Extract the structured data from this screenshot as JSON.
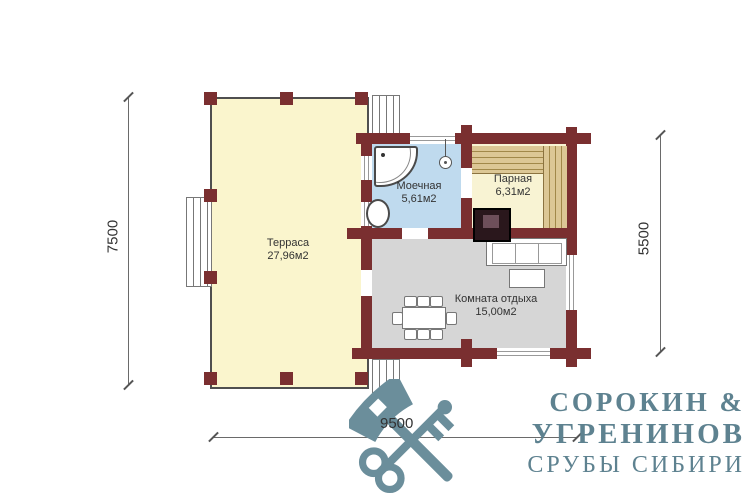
{
  "plan": {
    "dimensions": {
      "left": "7500",
      "right": "5500",
      "bottom": "9500"
    },
    "rooms": [
      {
        "id": "terrace",
        "name": "Терраса",
        "area": "27,96м2"
      },
      {
        "id": "washroom",
        "name": "Моечная",
        "area": "5,61м2"
      },
      {
        "id": "steam",
        "name": "Парная",
        "area": "6,31м2"
      },
      {
        "id": "lounge",
        "name": "Комната отдыха",
        "area": "15,00м2"
      }
    ],
    "colors": {
      "wall": "#7a2f30",
      "terrace_floor": "#faf5cd",
      "washroom_floor": "#bfdaee",
      "steam_floor": "#f8f3d3",
      "lounge_floor": "#d6d6d6",
      "bench": "#dcc795",
      "logo": "#5e8290"
    },
    "fixture_icons": [
      "shower-tray-icon",
      "shower-head-icon",
      "sink-icon",
      "sauna-bench-icon",
      "stove-icon",
      "sofa-icon",
      "coffee-table-icon",
      "dining-table-icon",
      "chair-icon",
      "stairs-icon"
    ]
  },
  "logo": {
    "icon": "crossed-axe-and-key",
    "line1": "СОРОКИН &",
    "line2": "УГРЕНИНОВ",
    "line3": "СРУБЫ СИБИРИ"
  }
}
